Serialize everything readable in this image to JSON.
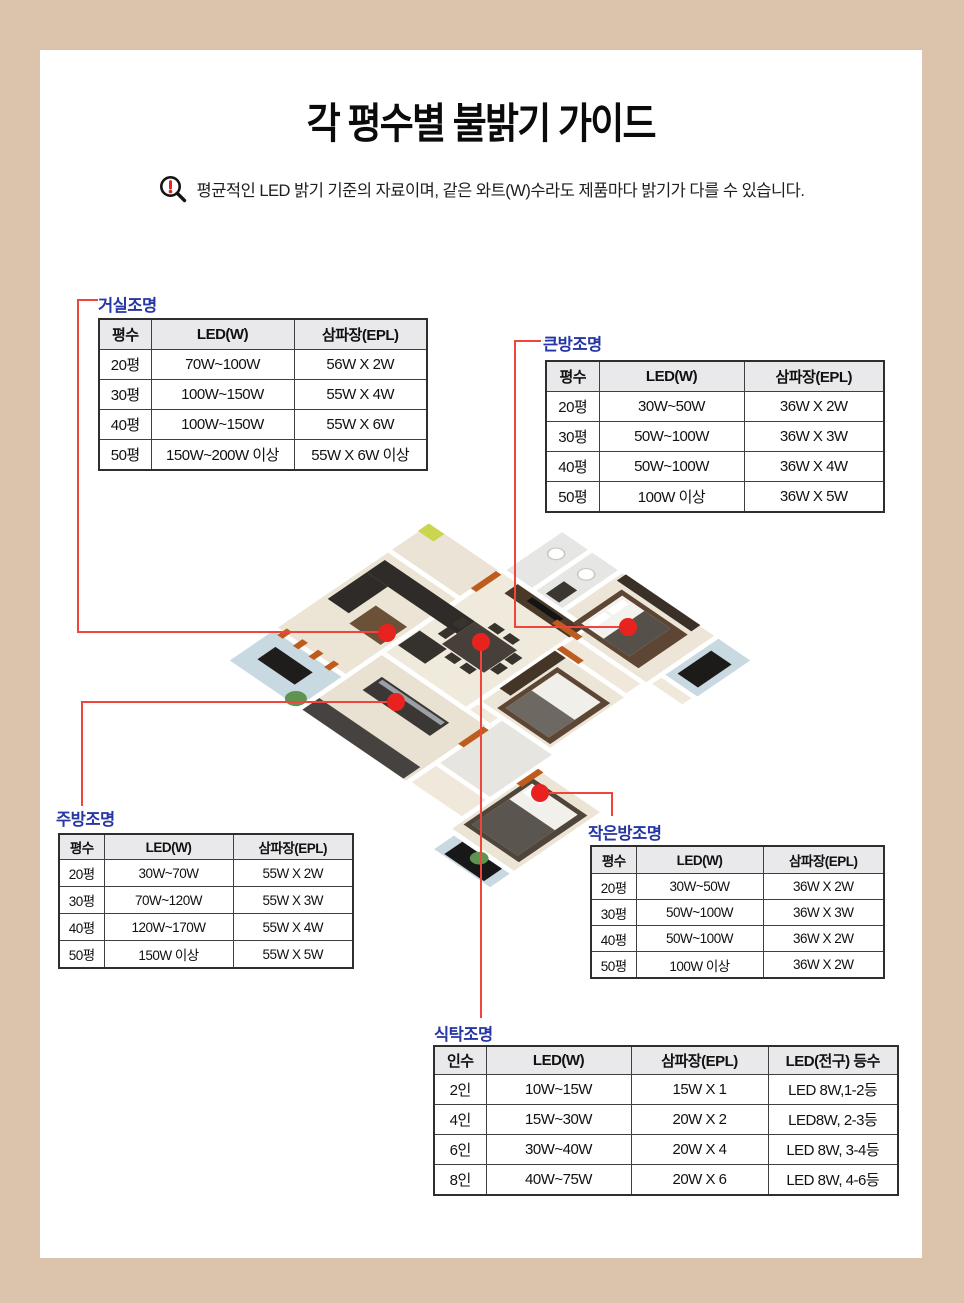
{
  "page": {
    "title": "각 평수별 불밝기 가이드",
    "notice": "평균적인 LED 밝기 기준의 자료이며, 같은 와트(W)수라도 제품마다 밝기가 다를 수 있습니다.",
    "frame_color": "#dcc3ab",
    "label_color": "#2636a4",
    "line_color": "#ef453c",
    "dot_color": "#e8231f",
    "notice_icon": "magnifier-exclamation-icon"
  },
  "tables": {
    "living": {
      "label": "거실조명",
      "headers": [
        "평수",
        "LED(W)",
        "삼파장(EPL)"
      ],
      "rows": [
        [
          "20평",
          "70W~100W",
          "56W X 2W"
        ],
        [
          "30평",
          "100W~150W",
          "55W X 4W"
        ],
        [
          "40평",
          "100W~150W",
          "55W X 6W"
        ],
        [
          "50평",
          "150W~200W 이상",
          "55W X 6W 이상"
        ]
      ]
    },
    "big_room": {
      "label": "큰방조명",
      "headers": [
        "평수",
        "LED(W)",
        "삼파장(EPL)"
      ],
      "rows": [
        [
          "20평",
          "30W~50W",
          "36W X 2W"
        ],
        [
          "30평",
          "50W~100W",
          "36W X 3W"
        ],
        [
          "40평",
          "50W~100W",
          "36W X 4W"
        ],
        [
          "50평",
          "100W 이상",
          "36W X 5W"
        ]
      ]
    },
    "kitchen": {
      "label": "주방조명",
      "headers": [
        "평수",
        "LED(W)",
        "삼파장(EPL)"
      ],
      "rows": [
        [
          "20평",
          "30W~70W",
          "55W X 2W"
        ],
        [
          "30평",
          "70W~120W",
          "55W X 3W"
        ],
        [
          "40평",
          "120W~170W",
          "55W X 4W"
        ],
        [
          "50평",
          "150W 이상",
          "55W X 5W"
        ]
      ]
    },
    "small_room": {
      "label": "작은방조명",
      "headers": [
        "평수",
        "LED(W)",
        "삼파장(EPL)"
      ],
      "rows": [
        [
          "20평",
          "30W~50W",
          "36W X 2W"
        ],
        [
          "30평",
          "50W~100W",
          "36W X 3W"
        ],
        [
          "40평",
          "50W~100W",
          "36W X 2W"
        ],
        [
          "50평",
          "100W 이상",
          "36W X 2W"
        ]
      ]
    },
    "dining": {
      "label": "식탁조명",
      "headers": [
        "인수",
        "LED(W)",
        "삼파장(EPL)",
        "LED(전구) 등수"
      ],
      "rows": [
        [
          "2인",
          "10W~15W",
          "15W X 1",
          "LED 8W,1-2등"
        ],
        [
          "4인",
          "15W~30W",
          "20W X 2",
          "LED8W, 2-3등"
        ],
        [
          "6인",
          "30W~40W",
          "20W X 4",
          "LED 8W, 3-4등"
        ],
        [
          "8인",
          "40W~75W",
          "20W X 6",
          "LED 8W, 4-6등"
        ]
      ]
    }
  }
}
